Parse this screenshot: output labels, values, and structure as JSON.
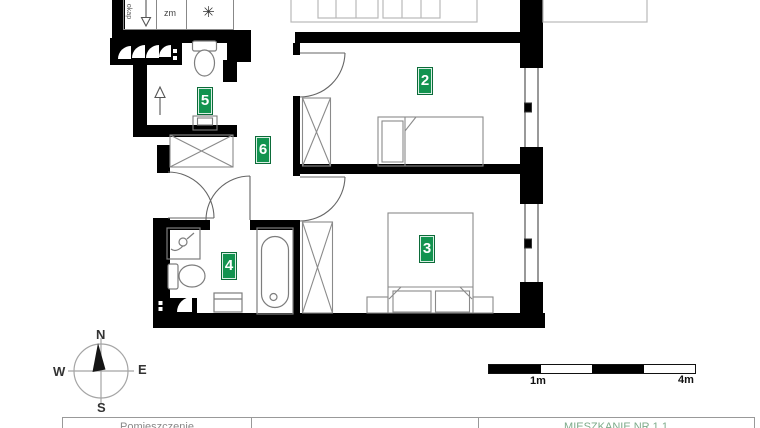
{
  "rooms": [
    {
      "number": "2"
    },
    {
      "number": "3"
    },
    {
      "number": "4"
    },
    {
      "number": "5"
    },
    {
      "number": "6"
    }
  ],
  "badge_color": "#12934f",
  "kitchen": {
    "hood_label": "okap",
    "dishwasher_label": "zm",
    "fridge_icon": "✳"
  },
  "compass": {
    "n": "N",
    "e": "E",
    "s": "S",
    "w": "W"
  },
  "scale_bar": {
    "mid_label": "1m",
    "end_label": "4m"
  },
  "footer_table": {
    "col_room": "Pomieszczenie",
    "col_mid": "",
    "col_apartment": "MIESZKANIE NR 1.1"
  }
}
